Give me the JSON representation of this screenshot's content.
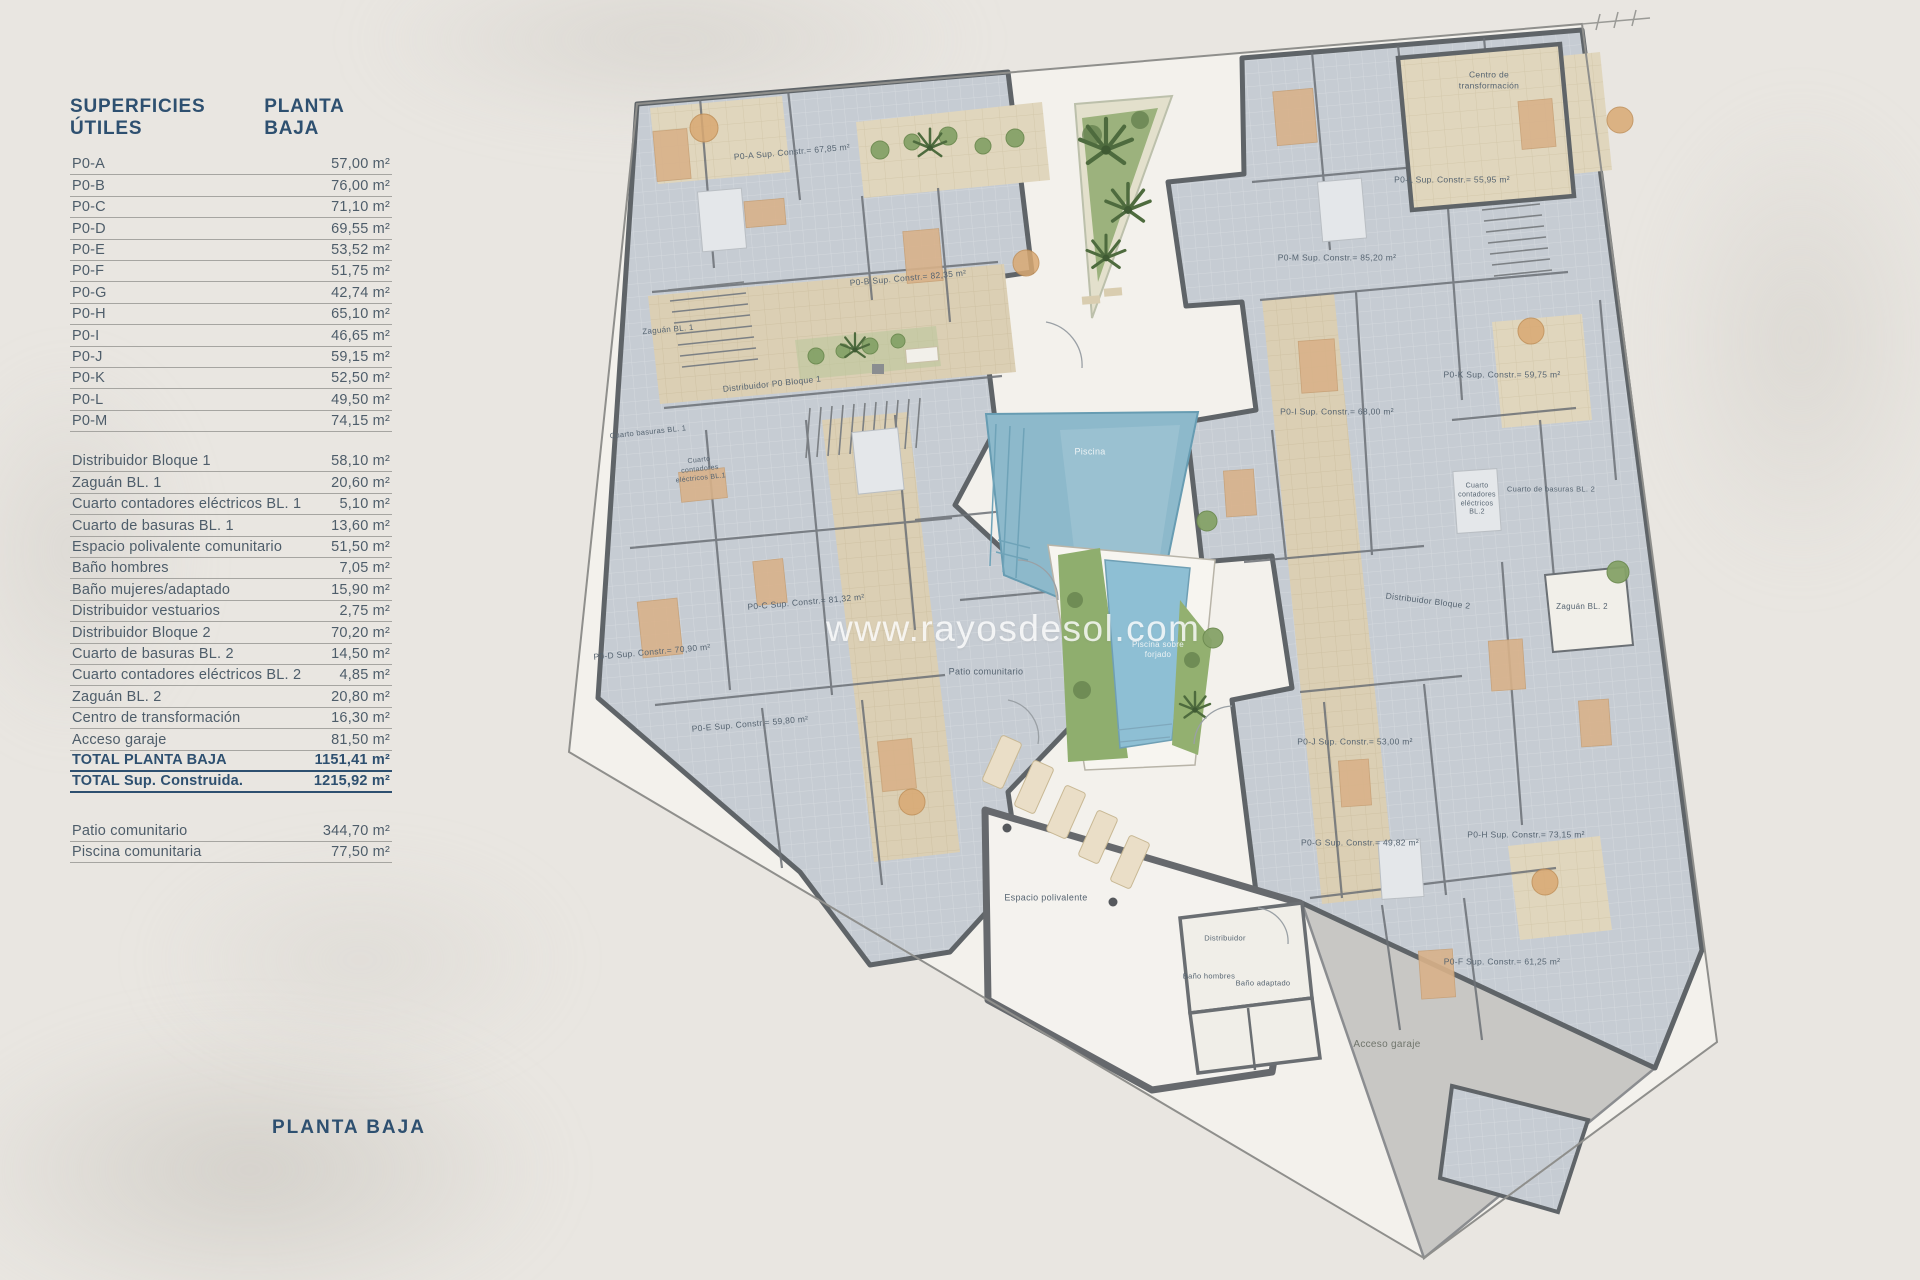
{
  "page": {
    "bottom_title": "PLANTA BAJA"
  },
  "table": {
    "title": "SUPERFICIES ÚTILES",
    "header_right": "PLANTA BAJA",
    "unit": "m²",
    "apartments": [
      {
        "label": "P0-A",
        "value": "57,00 m²"
      },
      {
        "label": "P0-B",
        "value": "76,00 m²"
      },
      {
        "label": "P0-C",
        "value": "71,10 m²"
      },
      {
        "label": "P0-D",
        "value": "69,55 m²"
      },
      {
        "label": "P0-E",
        "value": "53,52 m²"
      },
      {
        "label": "P0-F",
        "value": "51,75 m²"
      },
      {
        "label": "P0-G",
        "value": "42,74 m²"
      },
      {
        "label": "P0-H",
        "value": "65,10 m²"
      },
      {
        "label": "P0-I",
        "value": "46,65 m²"
      },
      {
        "label": "P0-J",
        "value": "59,15 m²"
      },
      {
        "label": "P0-K",
        "value": "52,50 m²"
      },
      {
        "label": "P0-L",
        "value": "49,50 m²"
      },
      {
        "label": "P0-M",
        "value": "74,15 m²"
      }
    ],
    "common": [
      {
        "label": "Distribuidor Bloque 1",
        "value": "58,10 m²"
      },
      {
        "label": "Zaguán BL. 1",
        "value": "20,60 m²"
      },
      {
        "label": "Cuarto contadores eléctricos BL. 1",
        "value": "5,10 m²"
      },
      {
        "label": "Cuarto de basuras BL. 1",
        "value": "13,60 m²"
      },
      {
        "label": "Espacio polivalente comunitario",
        "value": "51,50 m²"
      },
      {
        "label": "Baño hombres",
        "value": "7,05 m²"
      },
      {
        "label": "Baño mujeres/adaptado",
        "value": "15,90 m²"
      },
      {
        "label": "Distribuidor vestuarios",
        "value": "2,75 m²"
      },
      {
        "label": "Distribuidor Bloque 2",
        "value": "70,20 m²"
      },
      {
        "label": "Cuarto de basuras BL. 2",
        "value": "14,50 m²"
      },
      {
        "label": "Cuarto contadores eléctricos BL. 2",
        "value": "4,85 m²"
      },
      {
        "label": "Zaguán BL. 2",
        "value": "20,80 m²"
      },
      {
        "label": "Centro de transformación",
        "value": "16,30 m²"
      },
      {
        "label": "Acceso garaje",
        "value": "81,50 m²"
      }
    ],
    "totals": [
      {
        "label": "TOTAL PLANTA BAJA",
        "value": "1151,41 m²"
      },
      {
        "label": "TOTAL Sup. Construida.",
        "value": "1215,92 m²"
      }
    ],
    "outdoor": [
      {
        "label": "Patio comunitario",
        "value": "344,70 m²"
      },
      {
        "label": "Piscina comunitaria",
        "value": "77,50 m²"
      }
    ]
  },
  "plan": {
    "watermark": "www.rayosdesol.com",
    "colors": {
      "background": "#e9e6e1",
      "paper": "#f3f1ec",
      "room_gray": "#c6ccd3",
      "wall": "#5f6468",
      "corridor_tan": "#dbcfb4",
      "pool_blue": "#8db9cb",
      "garden_green": "#85a268",
      "heading_blue": "#2e5070",
      "row_text": "#4e5d6a",
      "garage_gray": "#c8c7c4"
    },
    "labels": [
      {
        "text": "P0-A Sup. Constr.= 67,85 m²",
        "x": 792,
        "y": 152,
        "rot": -5
      },
      {
        "text": "P0-B Sup. Constr.= 82,35 m²",
        "x": 908,
        "y": 278,
        "rot": -5
      },
      {
        "text": "Centro de\ntransformación",
        "x": 1489,
        "y": 80,
        "rot": 0,
        "size": 8.5
      },
      {
        "text": "P0-L Sup. Constr.= 55,95 m²",
        "x": 1452,
        "y": 180,
        "rot": 0
      },
      {
        "text": "P0-M Sup. Constr.= 85,20 m²",
        "x": 1337,
        "y": 258,
        "rot": 0
      },
      {
        "text": "P0-K Sup. Constr.= 59,75 m²",
        "x": 1502,
        "y": 375,
        "rot": 0
      },
      {
        "text": "P0-I Sup. Constr.= 68,00 m²",
        "x": 1337,
        "y": 412,
        "rot": 0
      },
      {
        "text": "Zaguán BL. 1",
        "x": 668,
        "y": 330,
        "rot": -5,
        "size": 8
      },
      {
        "text": "Distribuidor P0 Bloque 1",
        "x": 772,
        "y": 384,
        "rot": -6,
        "size": 8.5
      },
      {
        "text": "Cuarto basuras BL. 1",
        "x": 648,
        "y": 432,
        "rot": -6,
        "size": 7.5
      },
      {
        "text": "Cuarto\ncontadores\neléctricos BL.1",
        "x": 700,
        "y": 470,
        "rot": -6,
        "size": 7
      },
      {
        "text": "Cuarto de basuras BL. 2",
        "x": 1551,
        "y": 489,
        "rot": 0,
        "size": 7.5
      },
      {
        "text": "Cuarto\ncontadores\neléctricos\nBL.2",
        "x": 1477,
        "y": 500,
        "rot": 0,
        "size": 7
      },
      {
        "text": "Piscina",
        "x": 1090,
        "y": 452,
        "rot": 0,
        "size": 9,
        "color": "#edf3f5"
      },
      {
        "text": "P0-C Sup. Constr.= 81,32 m²",
        "x": 806,
        "y": 602,
        "rot": -5
      },
      {
        "text": "P0-D Sup. Constr.= 70,90 m²",
        "x": 652,
        "y": 652,
        "rot": -5
      },
      {
        "text": "Patio comunitario",
        "x": 986,
        "y": 672,
        "rot": 0,
        "size": 9
      },
      {
        "text": "Piscina sobre\nforjado",
        "x": 1158,
        "y": 650,
        "rot": 0,
        "size": 8,
        "color": "#ecf2f4"
      },
      {
        "text": "Distribuidor Bloque 2",
        "x": 1428,
        "y": 601,
        "rot": 7,
        "size": 8.5
      },
      {
        "text": "Zaguán BL. 2",
        "x": 1582,
        "y": 607,
        "rot": 0,
        "size": 8
      },
      {
        "text": "P0-E Sup. Constr.= 59,80 m²",
        "x": 750,
        "y": 724,
        "rot": -5
      },
      {
        "text": "P0-J Sup. Constr.= 53,00 m²",
        "x": 1355,
        "y": 742,
        "rot": 0
      },
      {
        "text": "P0-G Sup. Constr.= 49,82 m²",
        "x": 1360,
        "y": 843,
        "rot": 0
      },
      {
        "text": "P0-H Sup. Constr.= 73,15 m²",
        "x": 1526,
        "y": 835,
        "rot": 0
      },
      {
        "text": "P0-F Sup. Constr.= 61,25 m²",
        "x": 1502,
        "y": 962,
        "rot": 0
      },
      {
        "text": "Espacio polivalente",
        "x": 1046,
        "y": 898,
        "rot": 0,
        "size": 9
      },
      {
        "text": "Distribuidor",
        "x": 1225,
        "y": 938,
        "rot": 0,
        "size": 7.5
      },
      {
        "text": "Baño hombres",
        "x": 1209,
        "y": 976,
        "rot": 0,
        "size": 7.5
      },
      {
        "text": "Baño adaptado",
        "x": 1263,
        "y": 983,
        "rot": 0,
        "size": 7.5
      },
      {
        "text": "Acceso garaje",
        "x": 1387,
        "y": 1045,
        "rot": 0,
        "size": 10,
        "color": "#70756c"
      }
    ]
  }
}
